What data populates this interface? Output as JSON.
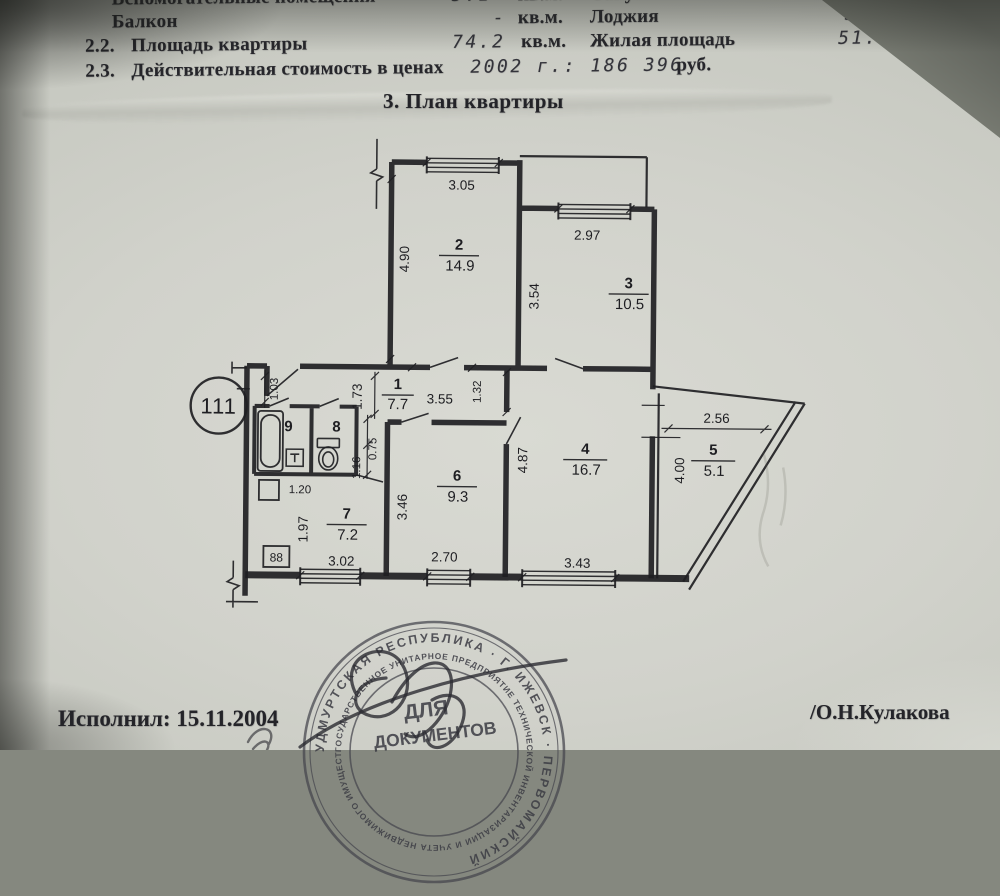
{
  "summary": {
    "aux_label": "Вспомогательные помещения",
    "aux_value": "5.1",
    "aux_unit": "кв.м.",
    "bath_label": "Санузел",
    "bath_value": "0.9 + 1.9",
    "bath_unit": "кв.м.",
    "balcony_label": "Балкон",
    "balcony_value": "-",
    "balcony_unit": "кв.м.",
    "loggia_label": "Лоджия",
    "loggia_value": "3.0",
    "loggia_unit": "кв.м.",
    "item22_num": "2.2.",
    "area_label": "Площадь квартиры",
    "area_value": "74.2",
    "area_unit": "кв.м.",
    "living_label": "Жилая площадь",
    "living_value": "51.4",
    "living_unit": "кв.м.",
    "item23_num": "2.3.",
    "cost_label": "Действительная стоимость в ценах",
    "cost_value": "2002 г.: 186 396",
    "cost_unit": "руб."
  },
  "section_title": "3. План квартиры",
  "plan": {
    "apartment_number": "111",
    "electric_panel": "88",
    "rooms": {
      "r1": {
        "num": "1",
        "area": "7.7"
      },
      "r2": {
        "num": "2",
        "area": "14.9"
      },
      "r3": {
        "num": "3",
        "area": "10.5"
      },
      "r4": {
        "num": "4",
        "area": "16.7"
      },
      "r5": {
        "num": "5",
        "area": "5.1"
      },
      "r6": {
        "num": "6",
        "area": "9.3"
      },
      "r7": {
        "num": "7",
        "area": "7.2"
      },
      "r8": {
        "num": "8"
      },
      "r9": {
        "num": "9"
      }
    },
    "dims": {
      "room2_width": "3.05",
      "room2_depth": "4.90",
      "room3_width": "2.97",
      "room3_depth": "3.54",
      "hall_niche": "1.03",
      "hall_depth": "1.73",
      "hall_width": "3.55",
      "hall_right": "1.32",
      "wc_width": "0.75",
      "wc_depth": "1.16",
      "closet_width": "1.20",
      "room7_depth": "1.97",
      "room7_width": "3.02",
      "room6_depth": "3.46",
      "room6_width": "2.70",
      "room4_depth": "4.87",
      "room4_width": "3.43",
      "loggia_width": "2.56",
      "loggia_depth": "4.00"
    }
  },
  "stamp": {
    "ring_outer_text": "УДМУРТСКАЯ РЕСПУБЛИКА · Г. ИЖЕВСК · ПЕРВОМАЙСКИЙ",
    "ring_inner_text": "ГОСУДАРСТВЕННОЕ УНИТАРНОЕ ПРЕДПРИЯТИЕ ТЕХНИЧЕСКОЙ ИНВЕНТАРИЗАЦИИ И УЧЕТА НЕДВИЖИМОГО ИМУЩЕСТВА",
    "center_line1": "ДЛЯ",
    "center_line2": "ДОКУМЕНТОВ"
  },
  "footer": {
    "executed": "Исполнил: 15.11.2004",
    "signatory": "/О.Н.Кулакова"
  }
}
